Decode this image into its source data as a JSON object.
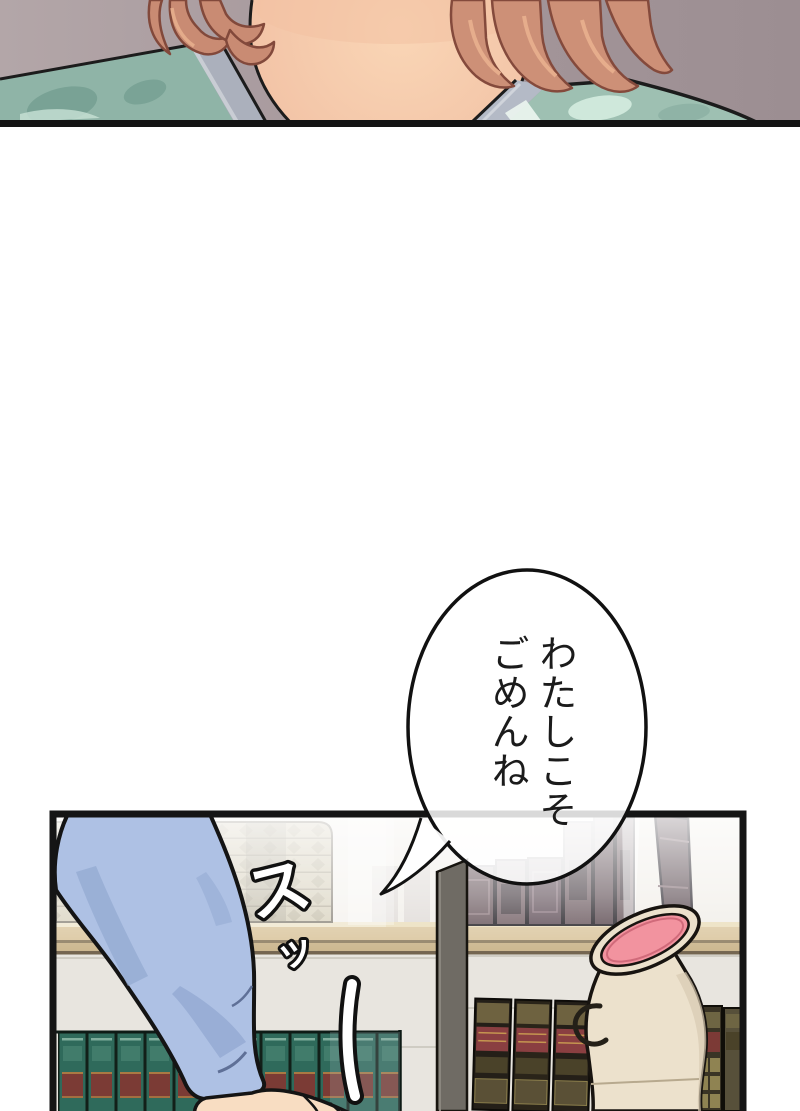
{
  "page": {
    "kind": "manga-webtoon-strip",
    "background": "#ffffff"
  },
  "speech_bubble": {
    "line1": "わたしこそ",
    "line2": "ごめんね",
    "fill": "#ffffff",
    "outline": "#111111"
  },
  "sfx": {
    "char1": "ス",
    "char2": "ッ",
    "style": "white-fill-black-outline"
  },
  "palette": {
    "top_panel_background": "#a5979b",
    "hair": "#cb8d74",
    "skin": "#f6cdae",
    "shirt_teal": "#95b9ab",
    "collar_gray": "#abb0bc",
    "panel_border": "#141414",
    "wall": "#e9e6e0",
    "shelf_board": "#d9c49c",
    "green_books": "#2f6a5b",
    "maroon_books": "#5f4c52",
    "tan_books": "#c9c0a4",
    "vase_body": "#ece1cc",
    "vase_mouth_pink": "#f2939f",
    "sleeve_blue": "#aec1e4",
    "post_gray": "#6f6b64"
  }
}
